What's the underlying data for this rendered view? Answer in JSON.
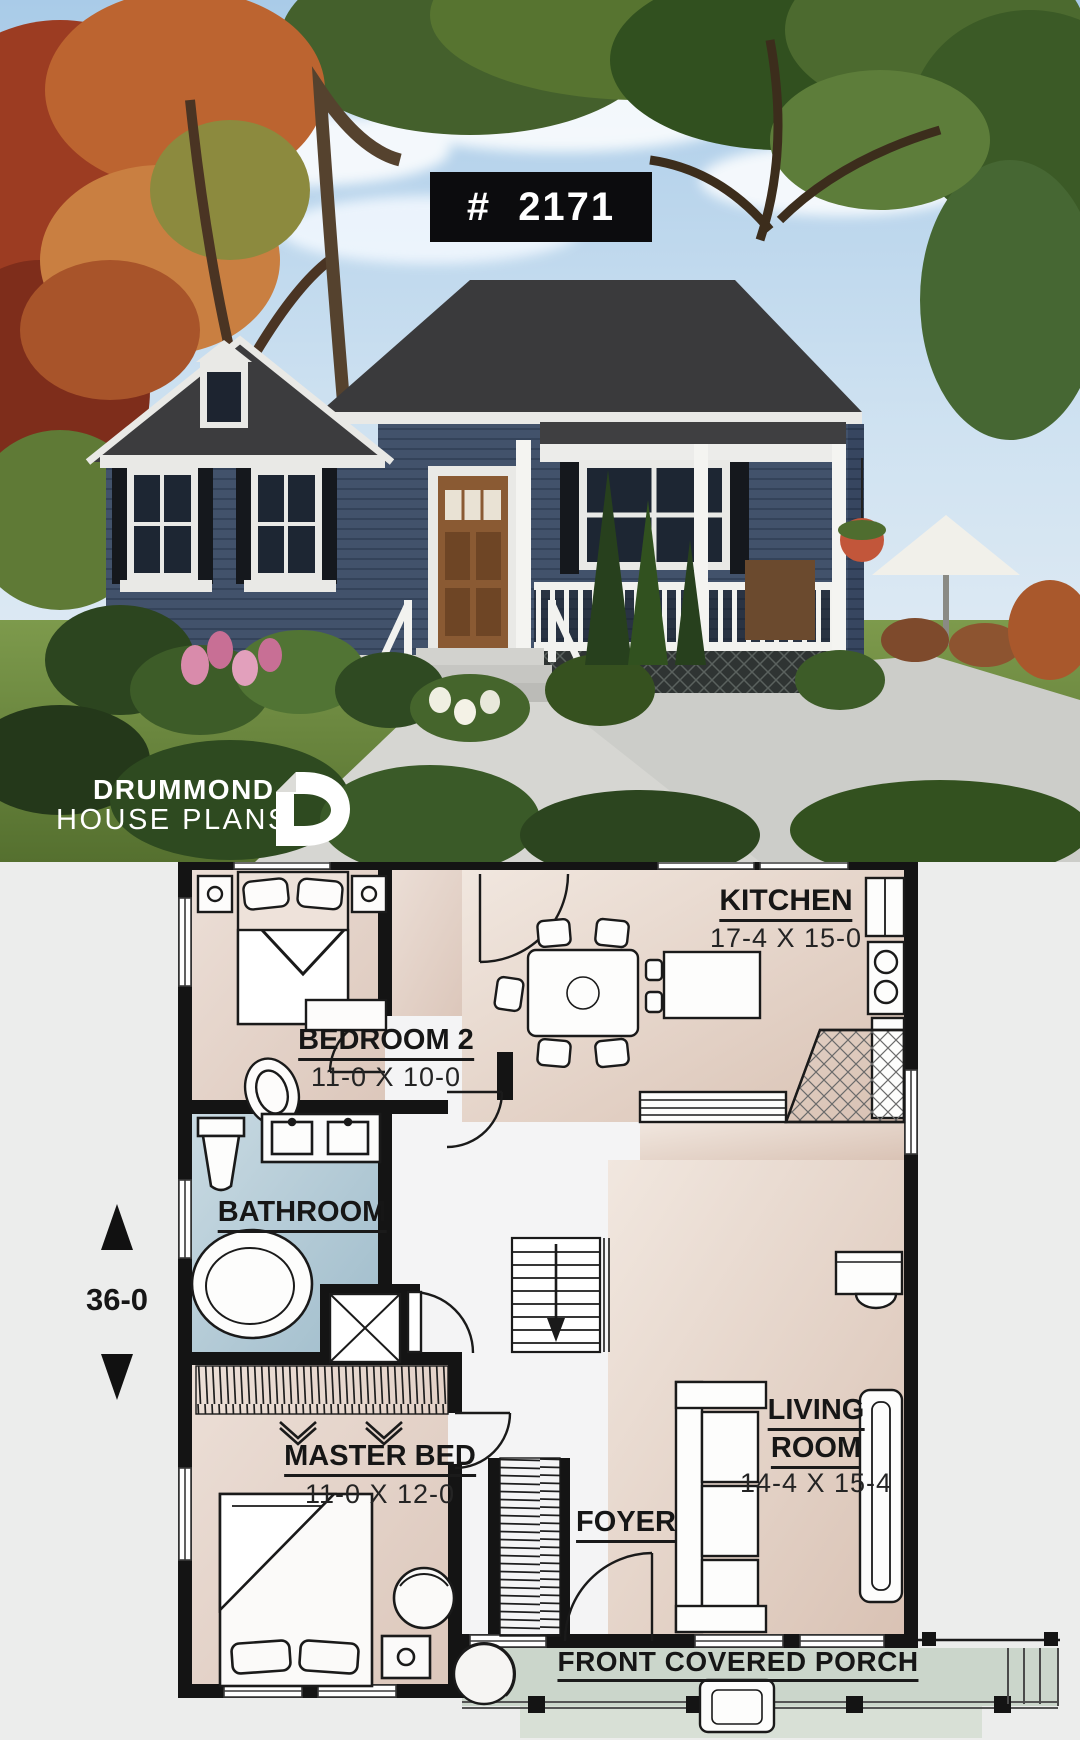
{
  "photo": {
    "plate_number": "# 2171",
    "logo": {
      "line1": "DRUMMOND",
      "line2": "HOUSE PLANS",
      "monogram": "D"
    }
  },
  "plan": {
    "overall_depth": "36-0",
    "rooms": {
      "kitchen": {
        "name": "KITCHEN",
        "dims": "17-4 X 15-0"
      },
      "bedroom2": {
        "name": "BEDROOM 2",
        "dims": "11-0 X 10-0"
      },
      "bathroom": {
        "name": "BATHROOM"
      },
      "master": {
        "name": "MASTER BED",
        "dims": "11-0 X 12-0"
      },
      "living": {
        "line1": "LIVING",
        "line2": "ROOM",
        "dims": "14-4 X 15-4"
      },
      "foyer": {
        "name": "FOYER"
      },
      "porch": {
        "name": "FRONT COVERED PORCH"
      }
    },
    "colors": {
      "wall": "#141414",
      "floor_beige": "#e2d0c4",
      "floor_blue": "#b3cbd8",
      "floor_porch": "#ccd7cc",
      "page": "#ecedec",
      "plate_bg": "#0c0c0e",
      "house_siding": "#42526b",
      "roof": "#3a3a3c"
    }
  }
}
